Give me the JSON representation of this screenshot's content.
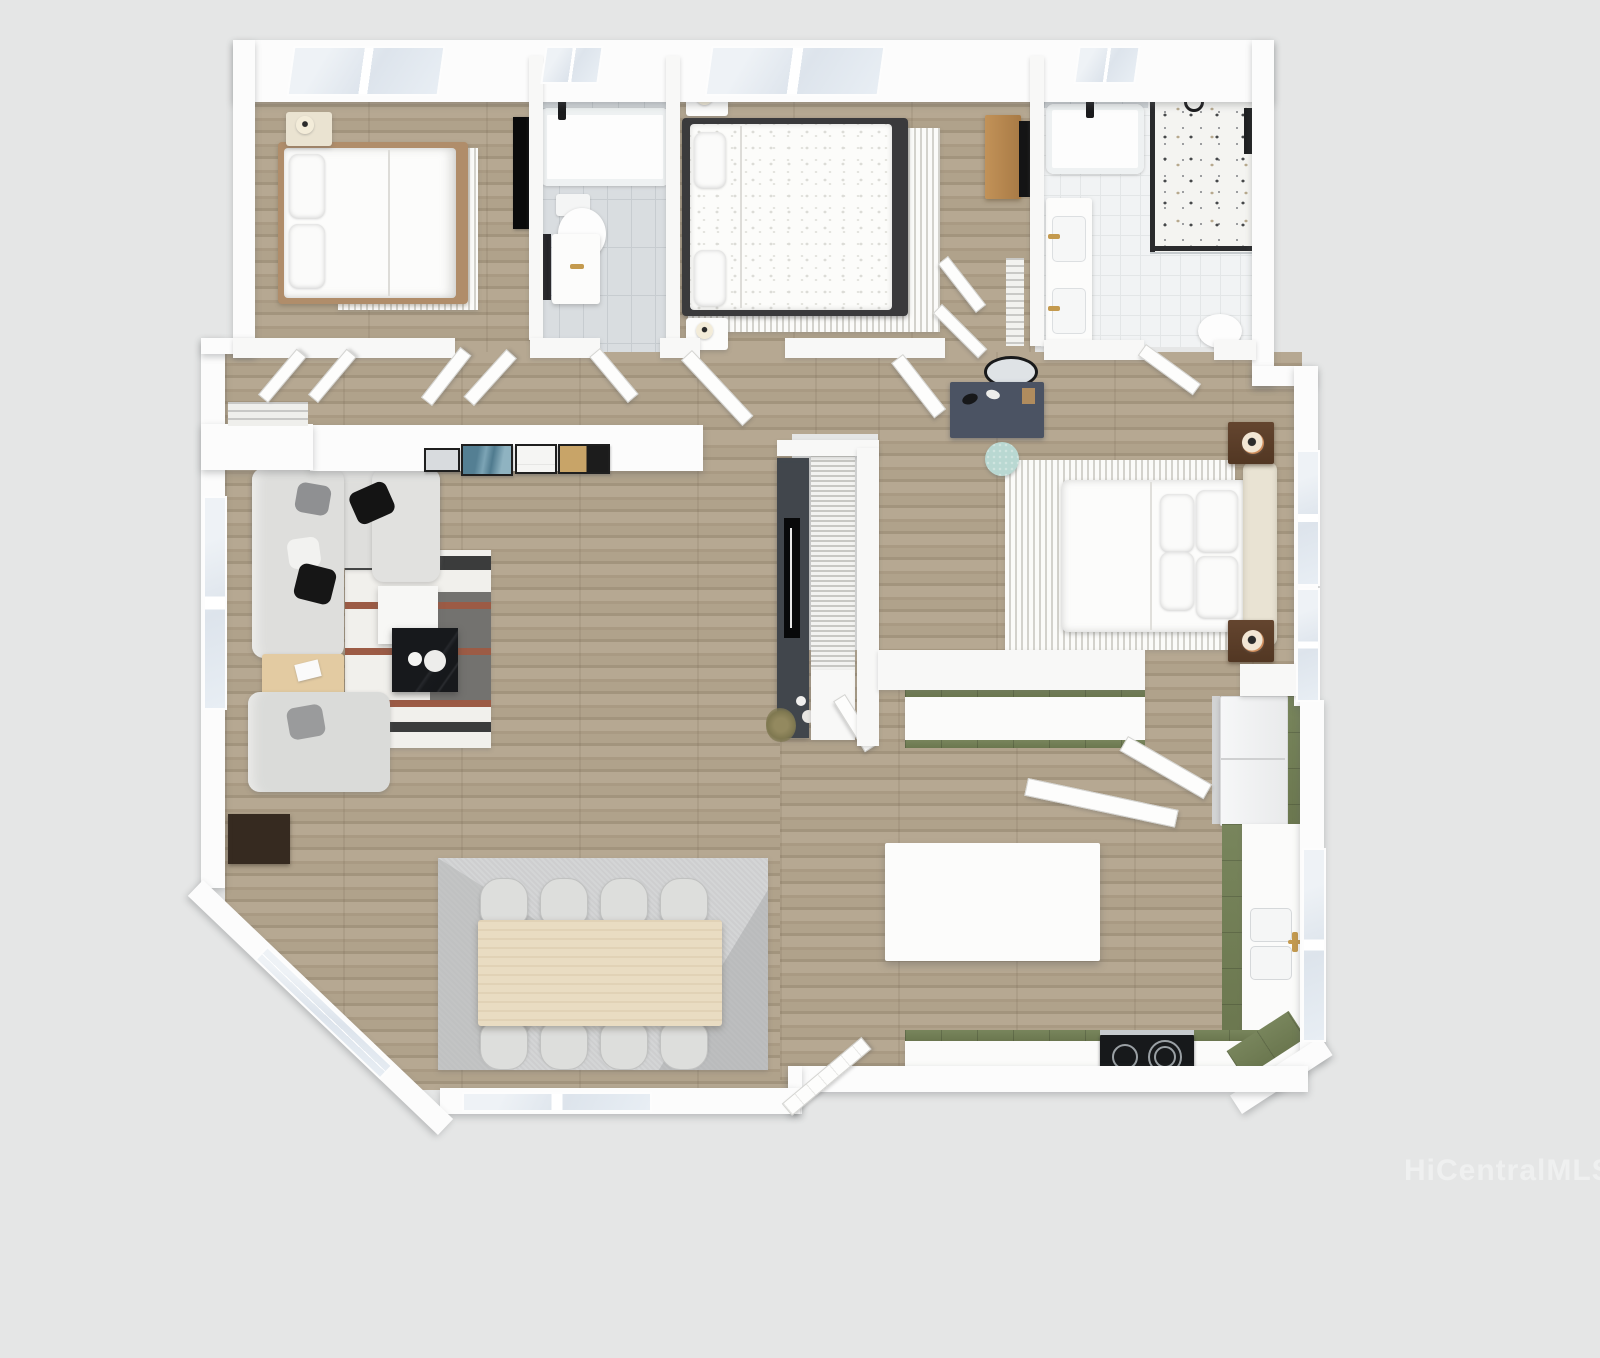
{
  "watermark": {
    "text": "HiCentralMLS",
    "color": "#eff0f0"
  },
  "background": "#e5e6e6",
  "palette": {
    "wall": "#fcfcfc",
    "wood_floor": "#ada089",
    "tile_gray": "#d9dde0",
    "tile_white": "#f1f3f4",
    "cabinet_green": "#6f7a52",
    "counter_white": "#fbfbfa",
    "faucet_gold": "#c49a4e",
    "tv_black": "#0a0a0b",
    "rug_stripe": "#d3d2cc",
    "marble_black": "#17191c",
    "stool_mint": "#b9d8d2",
    "nightstand_walnut": "#5a3d2b",
    "desk_slate": "#4b5363",
    "dining_table_wood": "#e9dcc2",
    "bedframe_wood": "#b08d6a",
    "dresser_wood": "#b5854e",
    "console_gray": "#41464c"
  },
  "scene": {
    "type": "3d-rendered-floor-plan",
    "view": "top-down",
    "rooms": [
      {
        "name": "bedroom-1",
        "position": "top-left",
        "furniture": [
          "double-bed",
          "wood-bed-frame",
          "nightstand",
          "table-lamp",
          "striped-rug",
          "wall-tv",
          "window"
        ]
      },
      {
        "name": "bathroom-1",
        "position": "top-center-left",
        "furniture": [
          "bathtub",
          "toilet",
          "vanity-sink",
          "gold-faucet",
          "window"
        ]
      },
      {
        "name": "bedroom-2",
        "position": "top-center",
        "furniture": [
          "double-bed",
          "patterned-duvet",
          "nightstand",
          "nightstand",
          "table-lamp",
          "striped-rug",
          "dresser",
          "tv",
          "closet-open-doors",
          "window"
        ]
      },
      {
        "name": "master-bathroom",
        "position": "top-right",
        "furniture": [
          "bathtub",
          "walk-in-shower",
          "terrazzo-floor",
          "double-vanity",
          "gold-faucets",
          "toilet",
          "window"
        ]
      },
      {
        "name": "hallway",
        "position": "center",
        "furniture": [
          "linen-closet",
          "wire-shelving",
          "open-doors"
        ]
      },
      {
        "name": "master-bedroom",
        "position": "center-right",
        "furniture": [
          "king-bed",
          "upholstered-headboard",
          "nightstand",
          "nightstand",
          "table-lamps",
          "striped-rug",
          "vanity-desk",
          "oval-mirror",
          "mint-stool",
          "slatted-closet",
          "windows"
        ]
      },
      {
        "name": "living-room",
        "position": "left",
        "furniture": [
          "sectional-sofa",
          "armchair",
          "throw-pillows",
          "striped-rug",
          "marble-coffee-table",
          "white-side-table",
          "wood-side-table",
          "dark-cabinet",
          "media-console",
          "tv",
          "plant",
          "gallery-wall-art",
          "window"
        ]
      },
      {
        "name": "dining-room",
        "position": "bottom-left",
        "furniture": [
          "dining-table",
          "chair",
          "chair",
          "chair",
          "chair",
          "chair",
          "chair",
          "chair",
          "chair",
          "geometric-rug",
          "bay-window"
        ]
      },
      {
        "name": "kitchen",
        "position": "bottom-right",
        "furniture": [
          "island",
          "peninsula-counter",
          "green-base-cabinets",
          "refrigerator",
          "pantry",
          "cooktop",
          "double-sink",
          "gold-faucet",
          "entry-door",
          "window"
        ]
      }
    ]
  }
}
